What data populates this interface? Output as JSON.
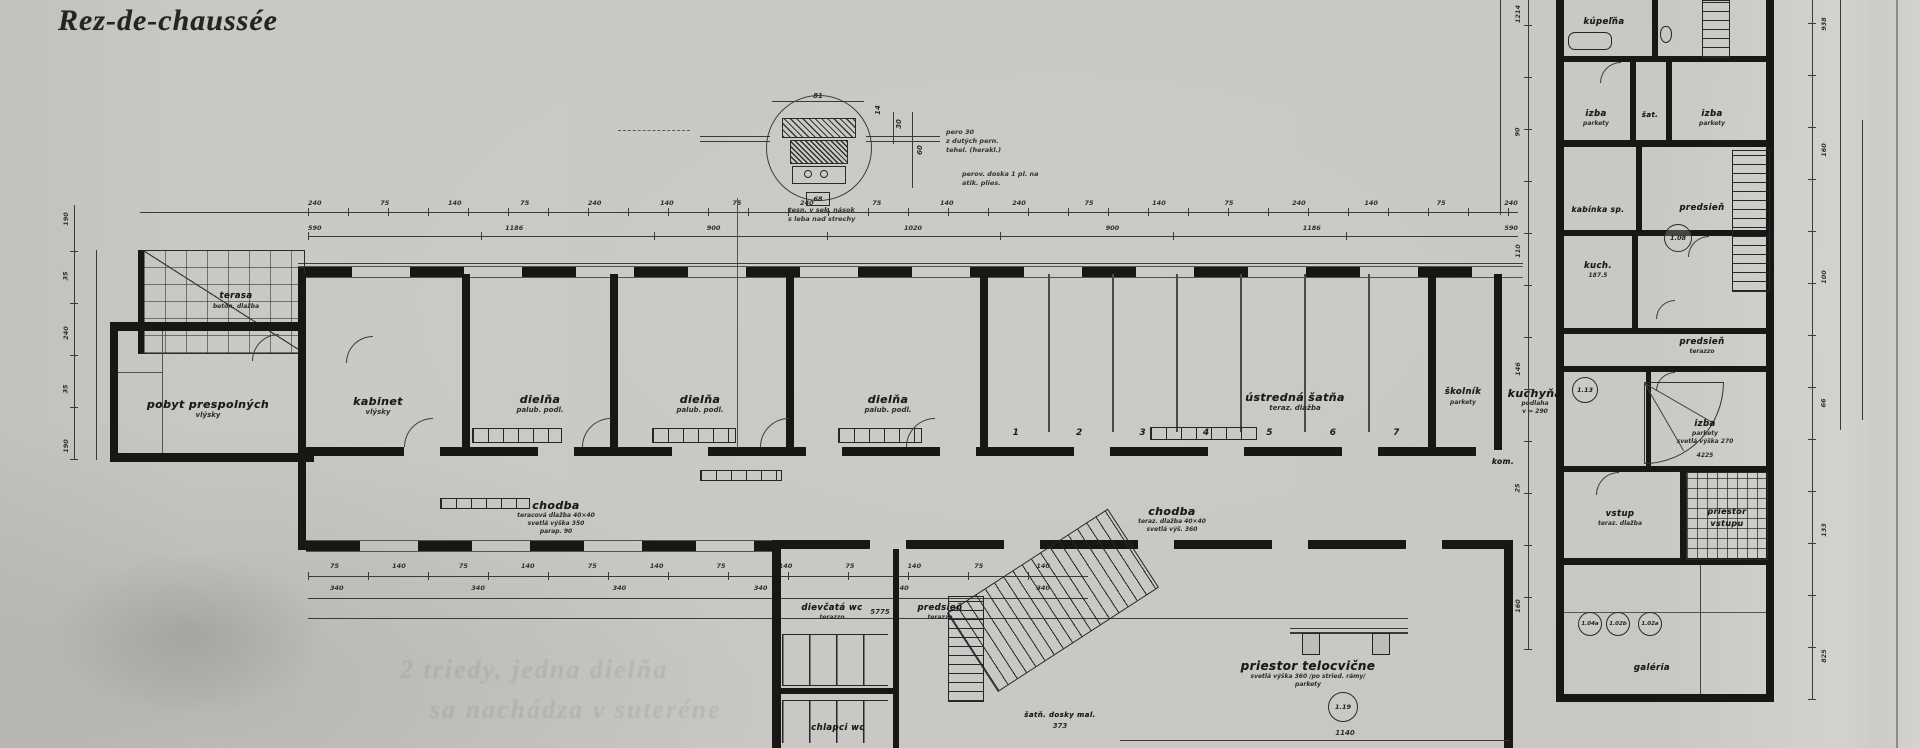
{
  "title": "Rez-de-chaussée",
  "rooms": {
    "terasa": {
      "label": "terasa",
      "sub": "betón. dlažba"
    },
    "pobyt": {
      "label": "pobyt prespolných",
      "sub": "vlýsky"
    },
    "kabinet": {
      "label": "kabinet",
      "sub": "vlýsky"
    },
    "dielna1": {
      "label": "dielňa",
      "sub": "palub. podl."
    },
    "dielna2": {
      "label": "dielňa",
      "sub": "palub. podl."
    },
    "dielna3": {
      "label": "dielňa",
      "sub": "palub. podl."
    },
    "satna": {
      "label": "ústredná šatňa",
      "sub": "teraz. dlažba"
    },
    "skolnik": {
      "label": "školník",
      "sub": "parkety"
    },
    "kuchyna": {
      "label": "kuchyňa",
      "sub1": "podlaha",
      "sub2": "v = 290",
      "circle": "1.13"
    },
    "kom": {
      "label": "kom."
    },
    "chodba_l": {
      "label": "chodba",
      "sub1": "teracová dlažba 40×40",
      "sub2": "svetlá výška 350",
      "sub3": "parap. 90"
    },
    "chodba_r": {
      "label": "chodba",
      "sub1": "teraz. dlažba 40×40",
      "sub2": "svetlá výš. 360"
    },
    "kupelna": {
      "label": "kúpeľňa"
    },
    "izba1": {
      "label": "izba",
      "sub": "parkety"
    },
    "sat": {
      "label": "šat."
    },
    "izba2": {
      "label": "izba",
      "sub": "parkety"
    },
    "kabinka": {
      "label": "kabínka sp."
    },
    "predsien1": {
      "label": "predsieň",
      "circle": "1.08"
    },
    "kuch": {
      "label": "kuch.",
      "sub": "187.5"
    },
    "predsien2": {
      "label": "predsieň",
      "sub": "terazzo"
    },
    "izba3": {
      "label": "izba",
      "sub1": "parkety",
      "sub2": "svetlá výška 270",
      "dim": "4225"
    },
    "vstup": {
      "label": "vstup",
      "sub": "teraz. dlažba"
    },
    "porch": {
      "line1": "priestor",
      "line2": "vstupu"
    },
    "galeria": {
      "label": "galéria"
    },
    "gym": {
      "label": "priestor telocvične",
      "sub1": "svetlá výška 360 /po stried. rámy/",
      "sub2": "parkety",
      "circle": "1.19"
    },
    "dievcata": {
      "label": "dievčatá wc",
      "sub": "terazzo"
    },
    "predsien3": {
      "label": "predsieň",
      "sub": "terazzo"
    },
    "chlapci": {
      "label": "chlapci wc"
    },
    "dosky": {
      "label": "šatň. dosky mal.",
      "dim": "373"
    }
  },
  "bays": [
    "1",
    "2",
    "3",
    "4",
    "5",
    "6",
    "7"
  ],
  "room_circles": [
    "1.04a",
    "1.02b",
    "1.02a"
  ],
  "detail": {
    "dim_top": "81",
    "dim_side": "14",
    "dim_r1": "30",
    "dim_r2": "60",
    "box": "68",
    "note1a": "pero 30",
    "note1b": "z dutých pern.",
    "note1c": "tehel. (herakl.)",
    "note2a": "perov. doska 1 pl. na",
    "note2b": "atik. plies.",
    "note3a": "tesn. v sek. nások",
    "note3b": "s leba nad strechy"
  },
  "dims": {
    "top_small": [
      "240",
      "75",
      "140",
      "75",
      "240",
      "140",
      "75",
      "240",
      "75",
      "140",
      "240",
      "75",
      "140",
      "75",
      "240",
      "140",
      "75",
      "240"
    ],
    "top_large": [
      "590",
      "1186",
      "900",
      "1020",
      "900",
      "1186",
      "590"
    ],
    "bottom_small": [
      "75",
      "140",
      "75",
      "140",
      "75",
      "140",
      "75",
      "140",
      "75",
      "140",
      "75",
      "140"
    ],
    "bottom_mid": [
      "340",
      "340",
      "340",
      "340",
      "340",
      "340"
    ],
    "bottom_total": "5775",
    "left_vert": [
      "190",
      "35",
      "240",
      "35",
      "190"
    ],
    "wing_west": [
      "1214",
      "90",
      "110",
      "146",
      "25",
      "160"
    ],
    "right_vert": [
      "938",
      "160",
      "100",
      "66",
      "133",
      "825"
    ],
    "gym_width": "1140"
  },
  "artifacts": {
    "bleed1": "2 triedy, jedna dielňa",
    "bleed2": "sa nachádza v suteréne"
  }
}
